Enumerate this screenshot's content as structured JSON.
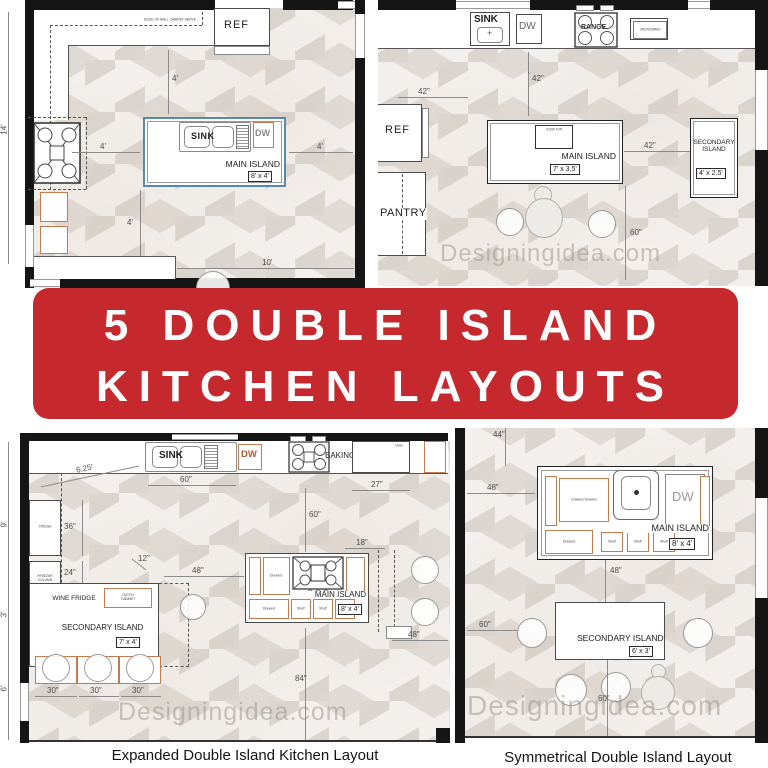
{
  "banner": {
    "line1": "5 DOUBLE ISLAND",
    "line2": "KITCHEN LAYOUTS",
    "bg_color": "#c5282d",
    "text_color": "#ffffff"
  },
  "watermark": "Designingidea.com",
  "captions": {
    "expanded": "Expanded Double Island Kitchen Layout",
    "symmetrical": "Symmetrical Double Island Layout"
  },
  "accent_colors": {
    "cabinet_outline": "#c57b4e",
    "island_outline_blue": "#5b87a8",
    "wall_black": "#151515"
  },
  "tl": {
    "ref": "REF",
    "sink": "SINK",
    "dw": "DW",
    "main_island": "MAIN ISLAND",
    "main_size": "8' x 4'",
    "edge_note": "EDGE OF WALL CABINET ABOVE",
    "d14": "14'",
    "d4_top": "4'",
    "d4_left": "4'",
    "d4_right": "4'",
    "d4_bottom": "4'",
    "d10": "10'"
  },
  "tr": {
    "sink": "SINK",
    "dw": "DW",
    "range": "RANGE",
    "microwave": "MICROWAVE",
    "ref": "REF",
    "pantry": "PANTRY",
    "cooktop": "COOKTOP",
    "main_island": "MAIN ISLAND",
    "main_size": "7' x 3.5'",
    "secondary_island": "SECONDARY ISLAND",
    "secondary_size": "4' x 2.5'",
    "d42_left": "42\"",
    "d42_top": "42\"",
    "d42_gap": "42\"",
    "d60": "60\""
  },
  "bl": {
    "sink": "SINK",
    "dw": "DW",
    "baking": "BAKING AREA",
    "oven": "Oven",
    "fridge": "FRIDGE",
    "freezer": "FREEZER COLUMN",
    "wine": "WINE FRIDGE",
    "hutch": "HUTCH CABINET",
    "secondary_island": "SECONDARY ISLAND",
    "secondary_size": "7' x 4'",
    "main_island": "MAIN ISLAND",
    "main_size": "8' x 4'",
    "drawers": "Drawers",
    "shelf": "Shelf",
    "d625": "6.25'",
    "d60_top": "60\"",
    "d27": "27\"",
    "d36": "36\"",
    "d24": "24\"",
    "d12": "12\"",
    "d48_mid": "48\"",
    "d18": "18\"",
    "d60_v": "60\"",
    "d48_right": "48\"",
    "d30": "30\"",
    "d84": "84\"",
    "d9": "9'",
    "d3": "3'",
    "d6": "6'"
  },
  "br": {
    "dw": "DW",
    "drawers": "Drawers",
    "drawers2": "Drawers Drawers",
    "shelf": "Shelf",
    "main_island": "MAIN ISLAND",
    "main_size": "8' x 4'",
    "secondary_island": "SECONDARY ISLAND",
    "secondary_size": "6' x 3'",
    "d44": "44\"",
    "d48_left": "48\"",
    "d48_mid": "48\"",
    "d60_left": "60\"",
    "d60_bottom": "60\""
  }
}
